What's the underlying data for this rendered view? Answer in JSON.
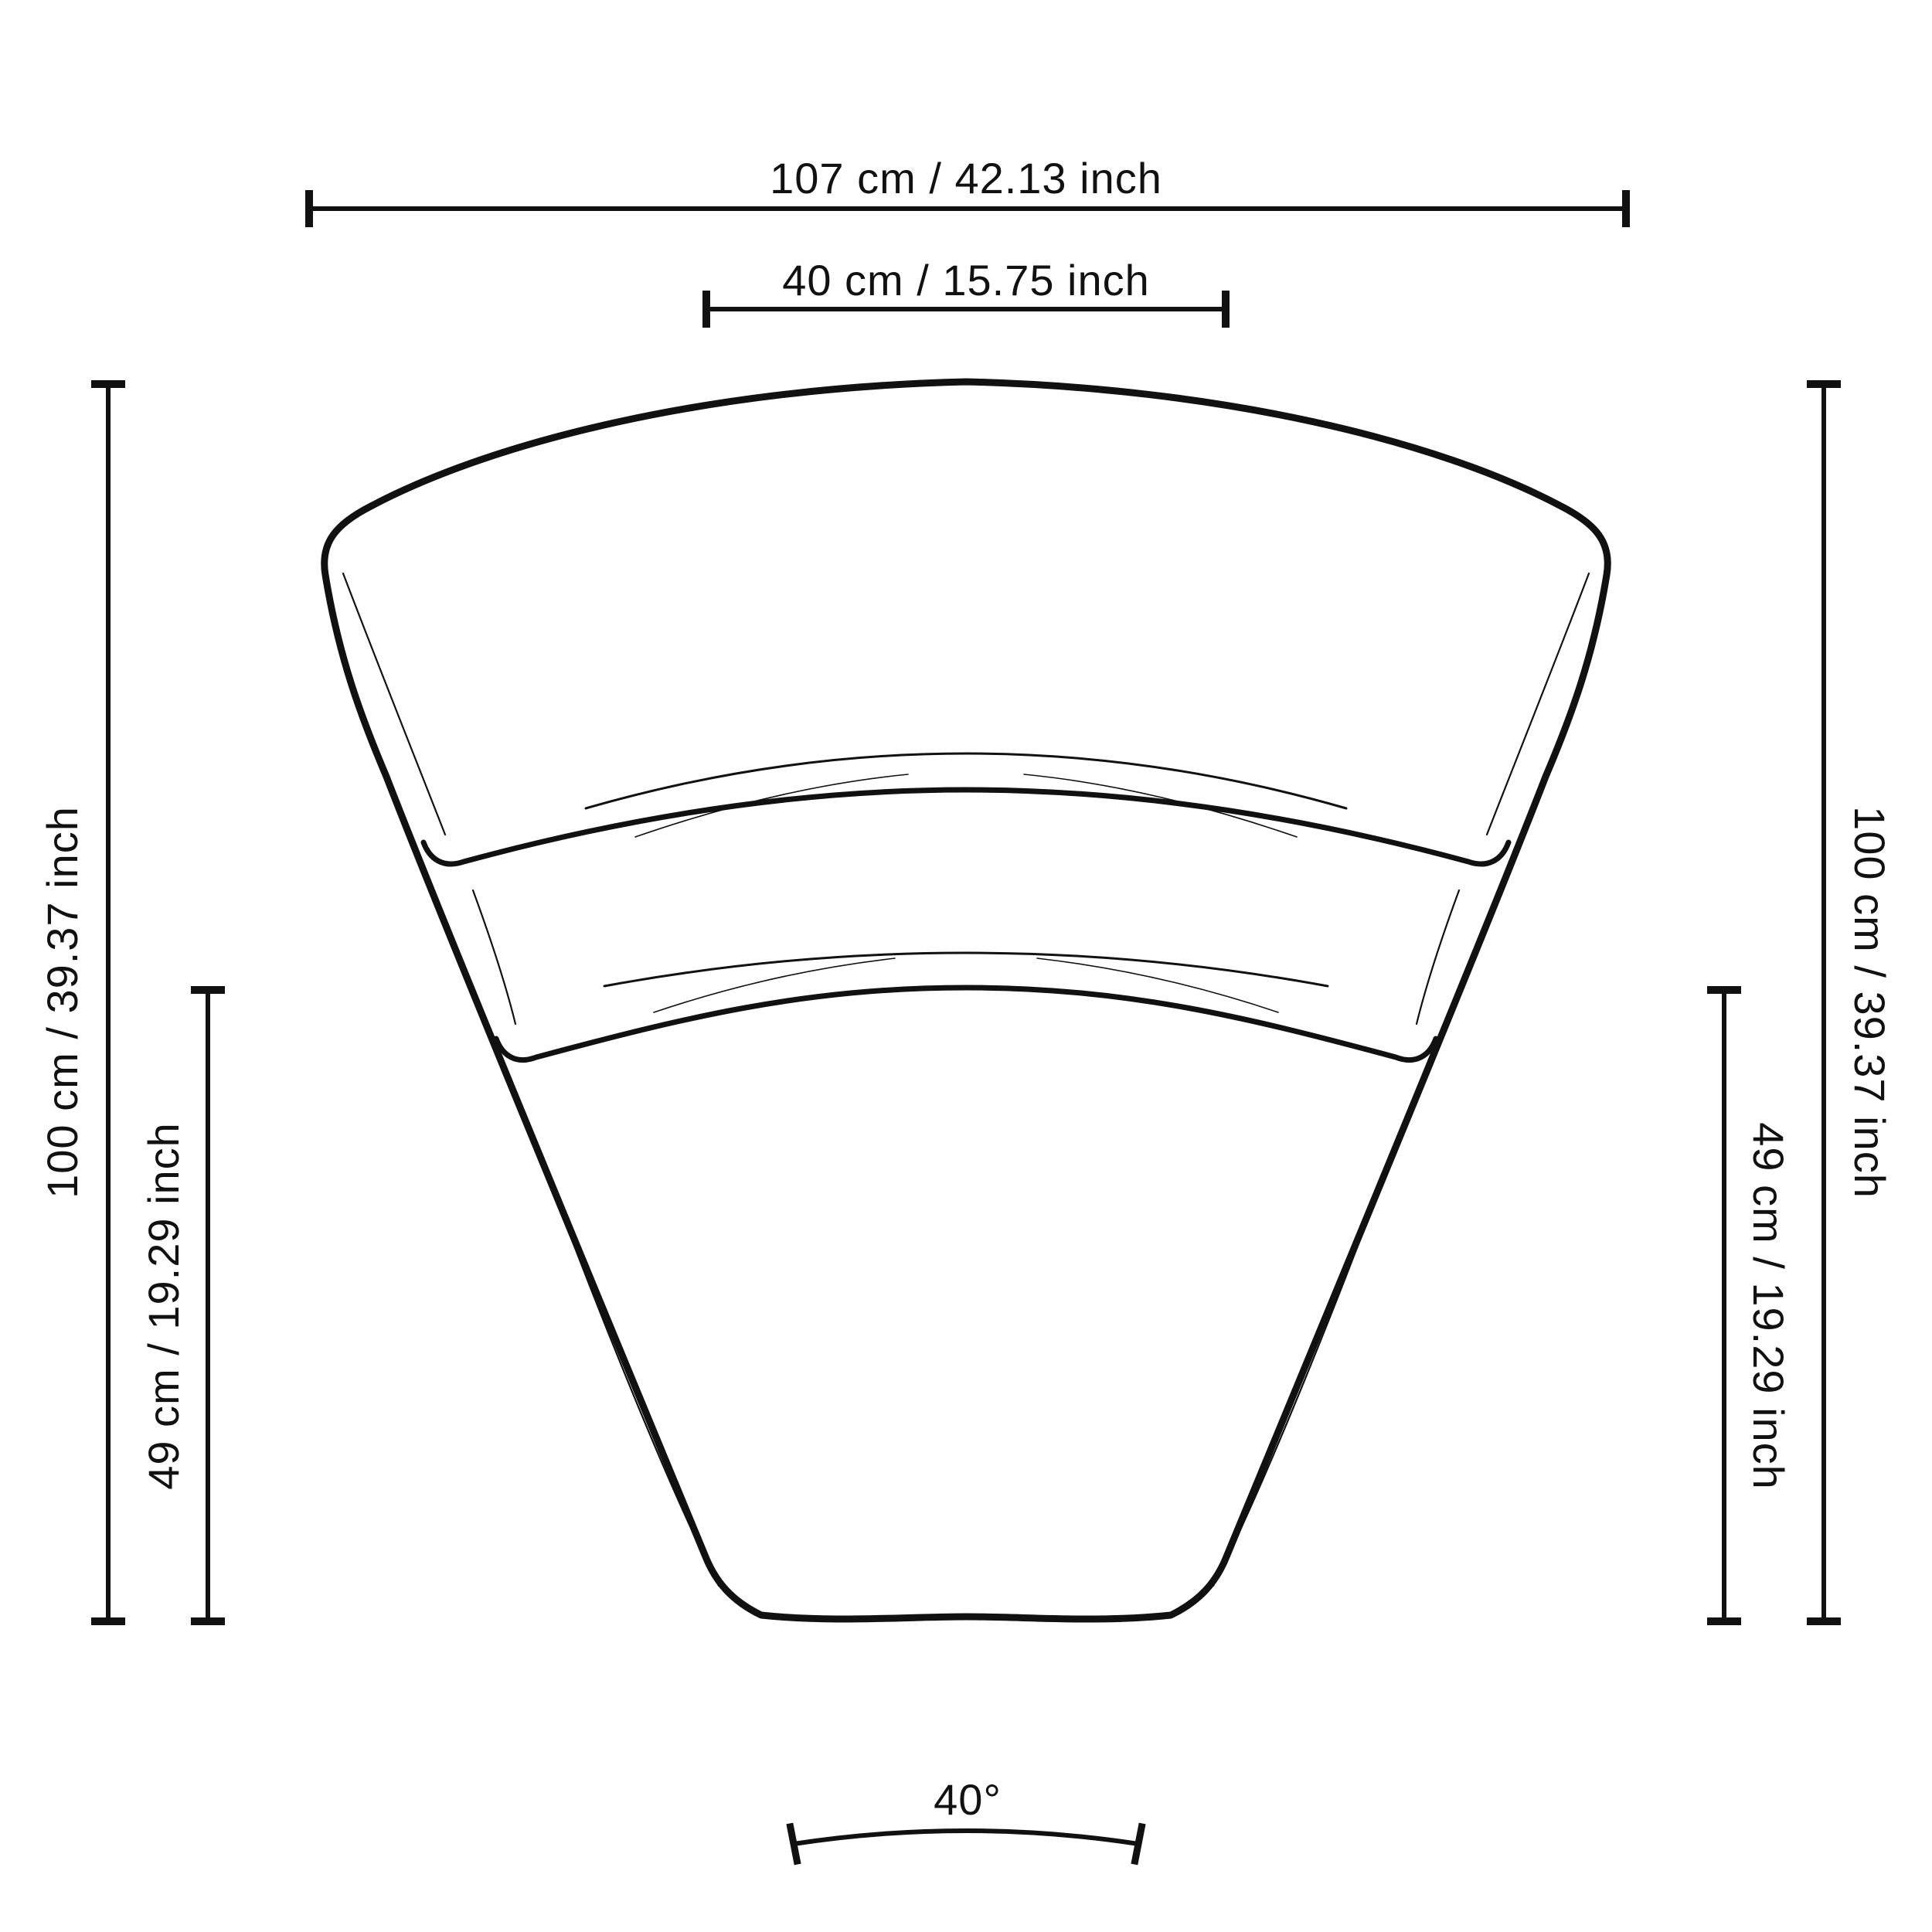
{
  "page": {
    "background_color": "#ffffff",
    "line_color": "#111111"
  },
  "dimensions": {
    "total_width": {
      "label": "107 cm / 42.13 inch"
    },
    "top_width": {
      "label": "40 cm / 15.75 inch"
    },
    "left_height": {
      "label": "100 cm / 39.37 inch"
    },
    "left_depth": {
      "label": "49 cm / 19.29 inch"
    },
    "right_height": {
      "label": "100 cm / 39.37 inch"
    },
    "right_depth": {
      "label": "49 cm / 19.29 inch"
    },
    "angle": {
      "label": "40°"
    }
  }
}
